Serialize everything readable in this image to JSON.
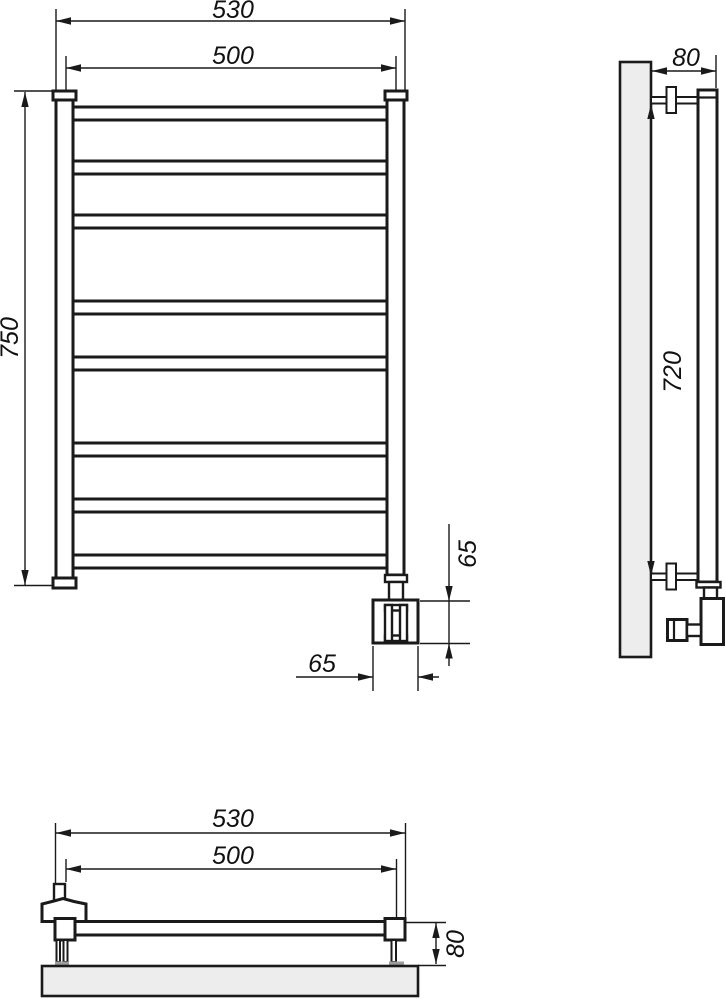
{
  "colors": {
    "line": "#1a1a1a",
    "wall_fill": "#ededed",
    "bracket_foot": "#9e9e9e"
  },
  "front_view": {
    "rung_count": 8,
    "dims": {
      "overall_width": "530",
      "pipe_centers_width": "500",
      "overall_height": "750",
      "valve_block_height": "65",
      "valve_block_width": "65"
    }
  },
  "side_view": {
    "dims": {
      "depth_from_wall": "80",
      "bracket_span": "720"
    }
  },
  "bottom_view": {
    "dims": {
      "overall_width": "530",
      "pipe_centers_width": "500",
      "depth_from_wall": "80"
    }
  }
}
